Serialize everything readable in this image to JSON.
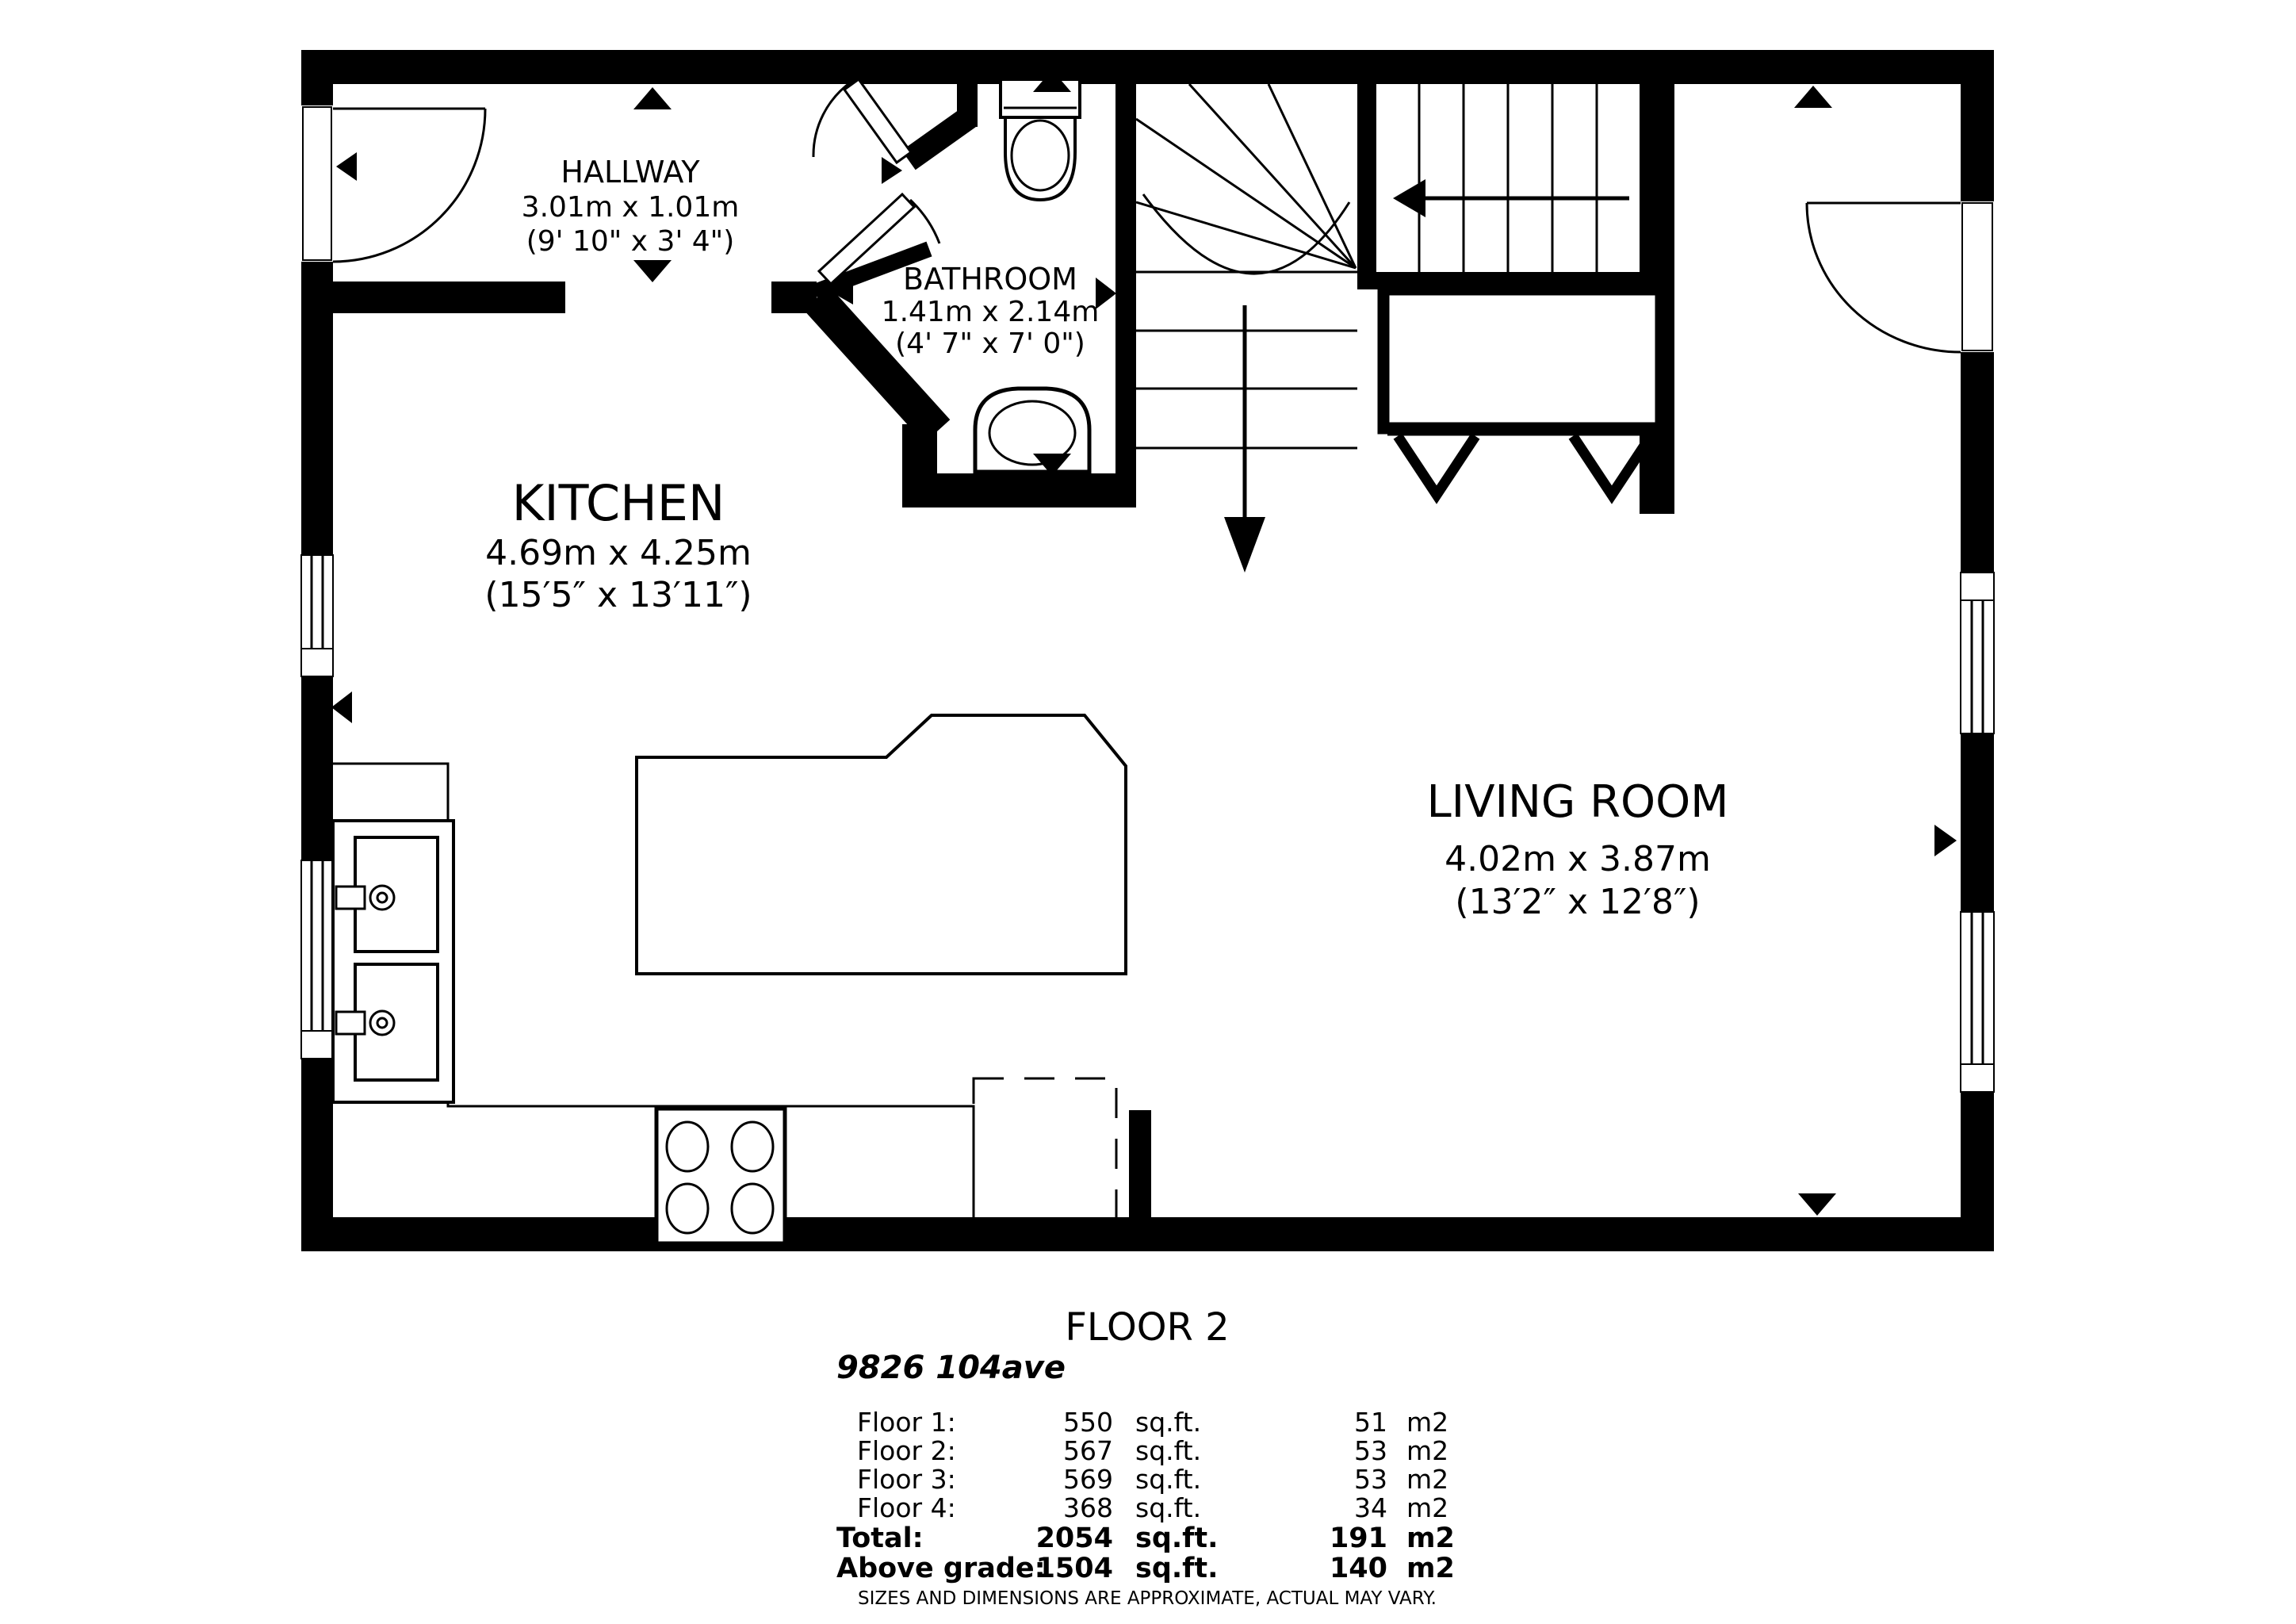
{
  "plan": {
    "rooms": [
      {
        "id": "hallway",
        "name": "HALLWAY",
        "dim_metric": "3.01m x 1.01m",
        "dim_imperial": "(9' 10\" x 3' 4\")"
      },
      {
        "id": "bathroom",
        "name": "BATHROOM",
        "dim_metric": "1.41m x 2.14m",
        "dim_imperial": "(4' 7\" x 7' 0\")"
      },
      {
        "id": "kitchen",
        "name": "KITCHEN",
        "dim_metric": "4.69m x 4.25m",
        "dim_imperial": "(15′5″ x 13′11″)"
      },
      {
        "id": "living_room",
        "name": "LIVING ROOM",
        "dim_metric": "4.02m x 3.87m",
        "dim_imperial": "(13′2″ x 12′8″)"
      }
    ],
    "icons": {
      "entry_door": "door-swing-icon",
      "living_room_door": "door-swing-icon",
      "bathroom_doors": "door-swing-icon",
      "toilet": "toilet-icon",
      "bathroom_sink": "sink-icon",
      "double_sink": "double-sink-icon",
      "stove": "stove-burners-icon",
      "island": "kitchen-island",
      "closet": "bifold-closet-doors",
      "stairs_down": "stairs-down-arrow",
      "stairs_run": "stairs-run-arrow",
      "direction_markers": "triangle-markers",
      "appliance_space": "dashed-appliance-box",
      "windows": "window-glazing"
    }
  },
  "footer": {
    "title": "FLOOR 2",
    "address": "9826 104ave",
    "area_table": {
      "rows": [
        {
          "label": "Floor 1:",
          "sqft": "550",
          "sqft_unit": "sq.ft.",
          "m2": "51",
          "m2_unit": "m2"
        },
        {
          "label": "Floor 2:",
          "sqft": "567",
          "sqft_unit": "sq.ft.",
          "m2": "53",
          "m2_unit": "m2"
        },
        {
          "label": "Floor 3:",
          "sqft": "569",
          "sqft_unit": "sq.ft.",
          "m2": "53",
          "m2_unit": "m2"
        },
        {
          "label": "Floor 4:",
          "sqft": "368",
          "sqft_unit": "sq.ft.",
          "m2": "34",
          "m2_unit": "m2"
        },
        {
          "label": "Total:",
          "sqft": "2054",
          "sqft_unit": "sq.ft.",
          "m2": "191",
          "m2_unit": "m2"
        },
        {
          "label": "Above grade:",
          "sqft": "1504",
          "sqft_unit": "sq.ft.",
          "m2": "140",
          "m2_unit": "m2"
        }
      ]
    },
    "disclaimer": "SIZES AND DIMENSIONS ARE APPROXIMATE, ACTUAL MAY VARY."
  },
  "colors": {
    "wall": "#000000",
    "background": "#ffffff",
    "disclaimer_text": "#9b9b9b"
  }
}
